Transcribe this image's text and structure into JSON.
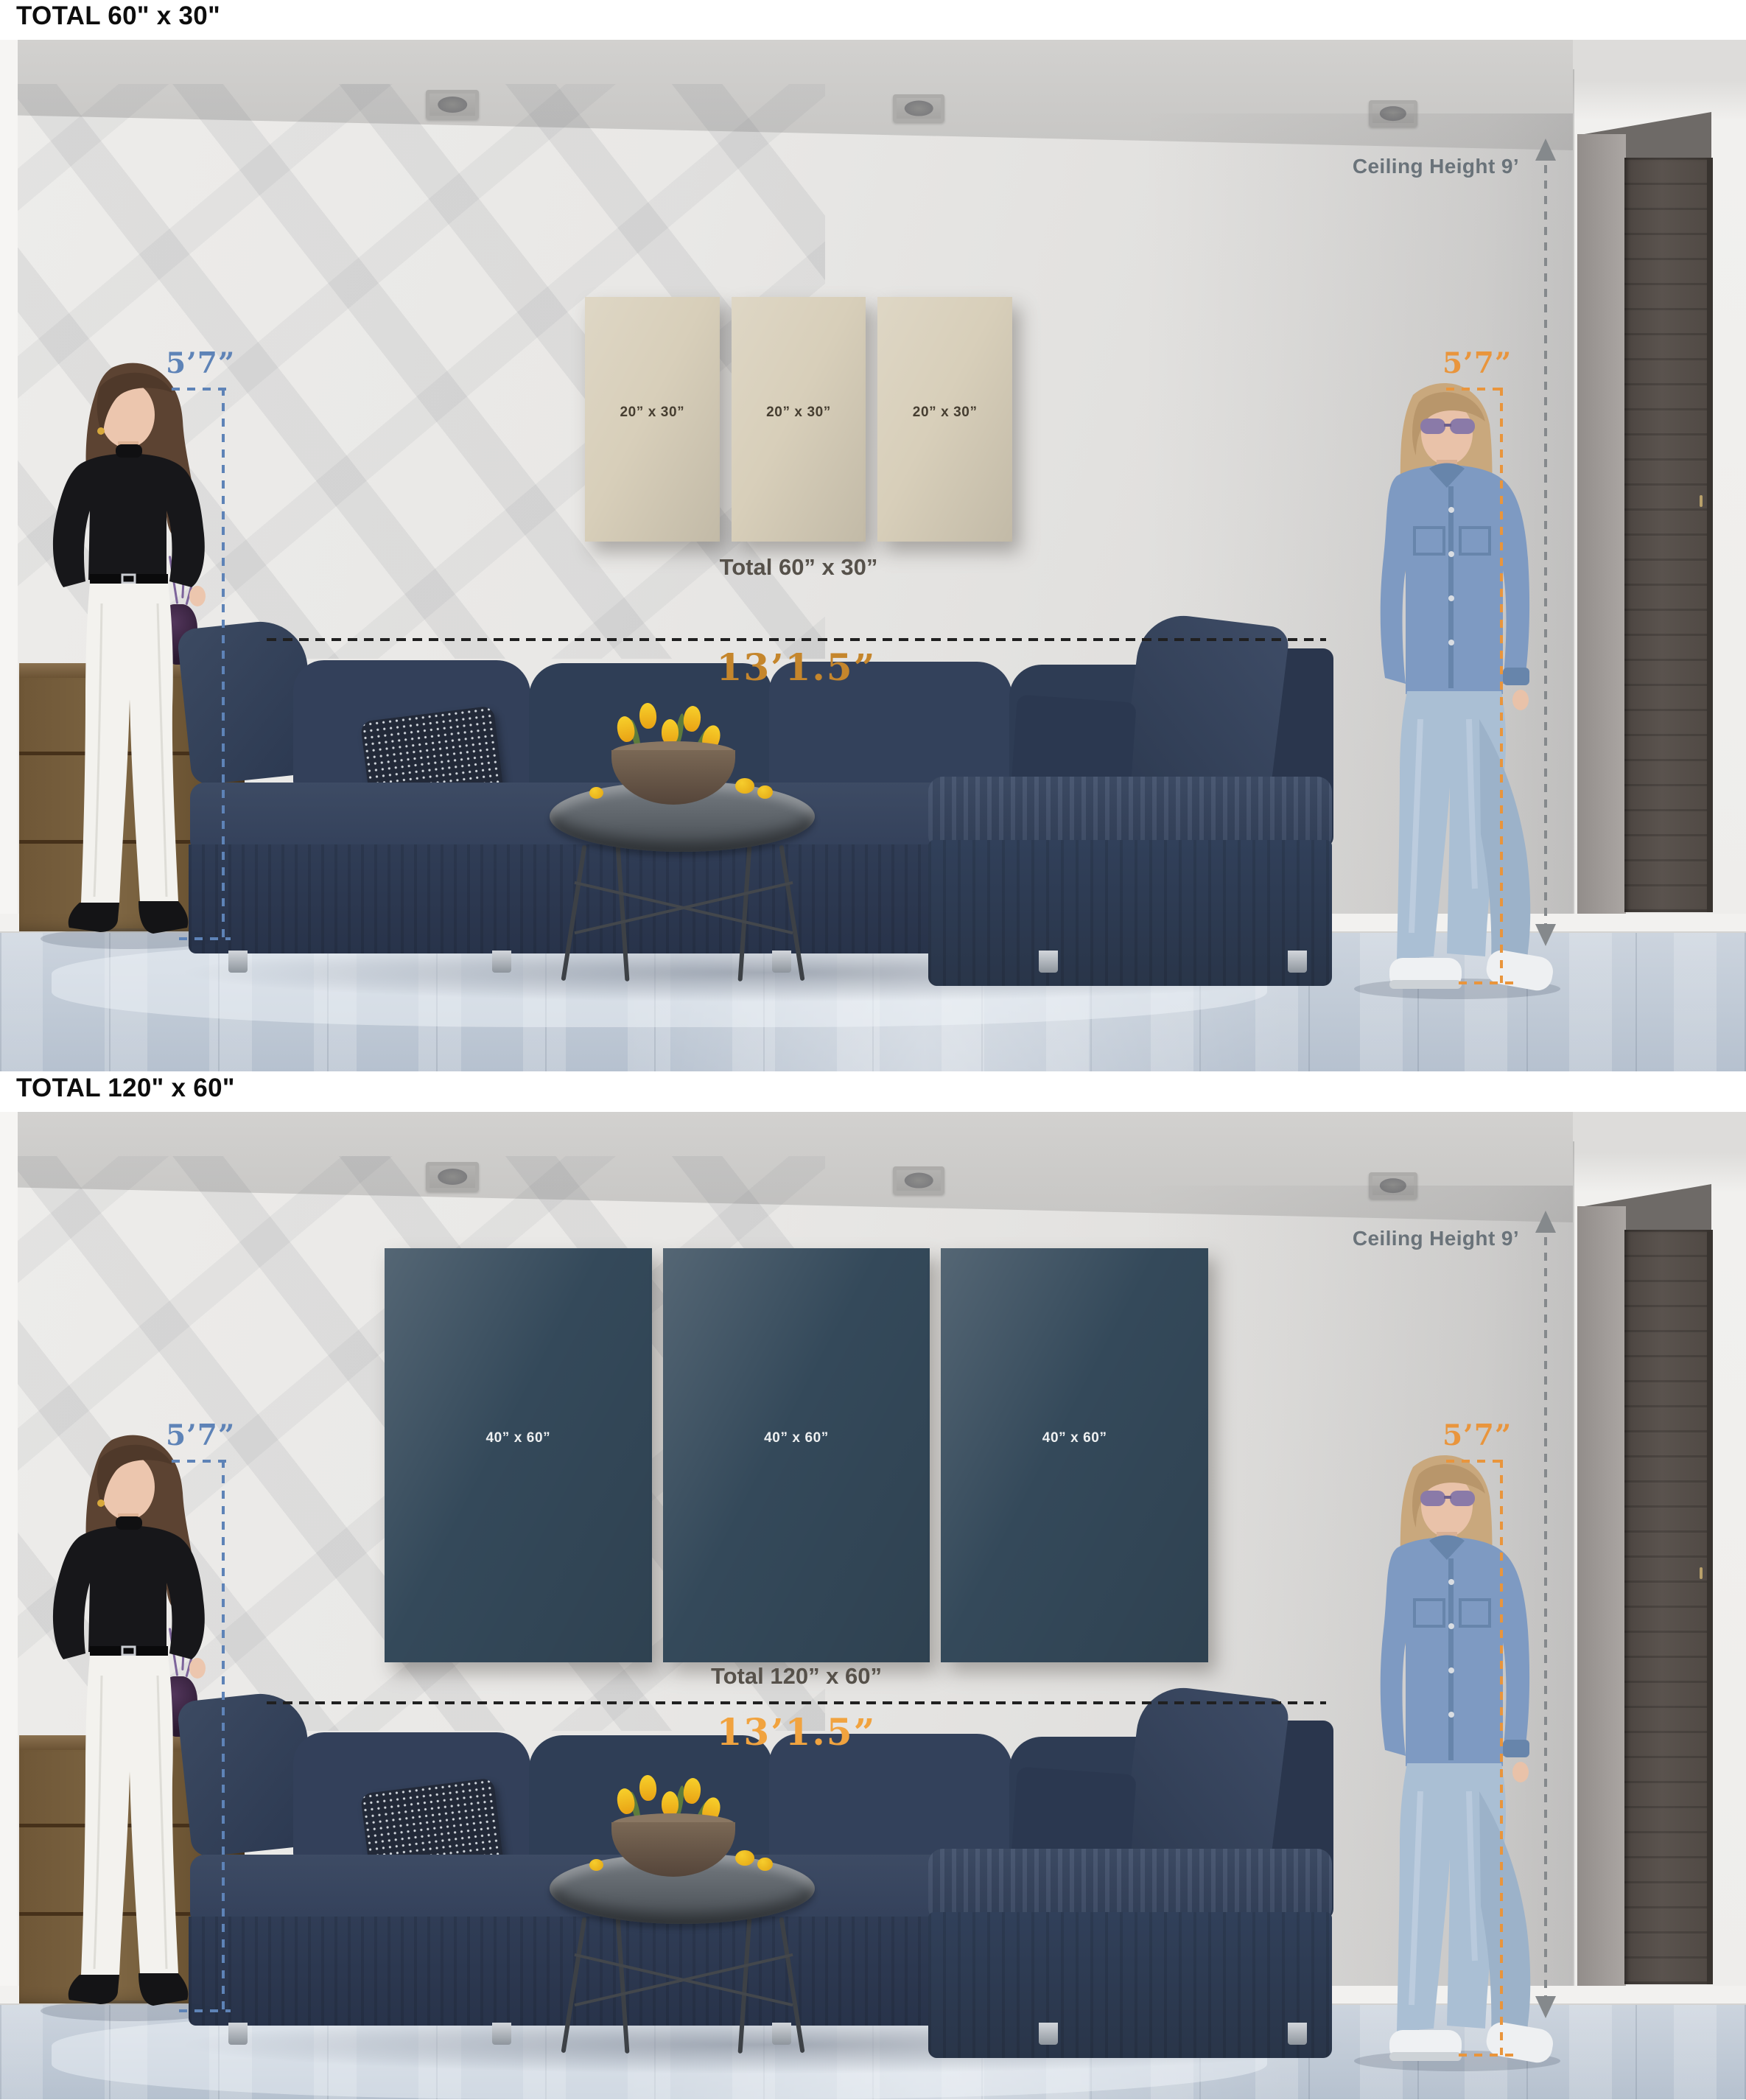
{
  "scenes": [
    {
      "title": "TOTAL 60\" x 30\"",
      "art": {
        "panel_labels": [
          "20” x 30”",
          "20” x 30”",
          "20” x 30”"
        ],
        "total_label": "Total 60” x 30”",
        "panel_color": "#d8cfba",
        "panel_label_color": "#463e31"
      },
      "annotations": {
        "left_height": "5’7”",
        "right_height": "5’7”",
        "ceiling": "Ceiling Height 9’",
        "width": "13’1.5”",
        "width_color": "#c5862c",
        "left_color": "#5e83b7",
        "right_color": "#e9953c",
        "ceiling_color": "#6a737a"
      }
    },
    {
      "title": "TOTAL 120\" x 60\"",
      "art": {
        "panel_labels": [
          "40” x 60”",
          "40” x 60”",
          "40” x 60”"
        ],
        "total_label": "Total 120” x 60”",
        "panel_color": "#34495a",
        "panel_label_color": "#eef0f1"
      },
      "annotations": {
        "left_height": "5’7”",
        "right_height": "5’7”",
        "ceiling": "Ceiling Height 9’",
        "width": "13’1.5”",
        "width_color": "#f1a33f",
        "left_color": "#5e83b7",
        "right_color": "#e9953c",
        "ceiling_color": "#6a737a"
      }
    }
  ]
}
